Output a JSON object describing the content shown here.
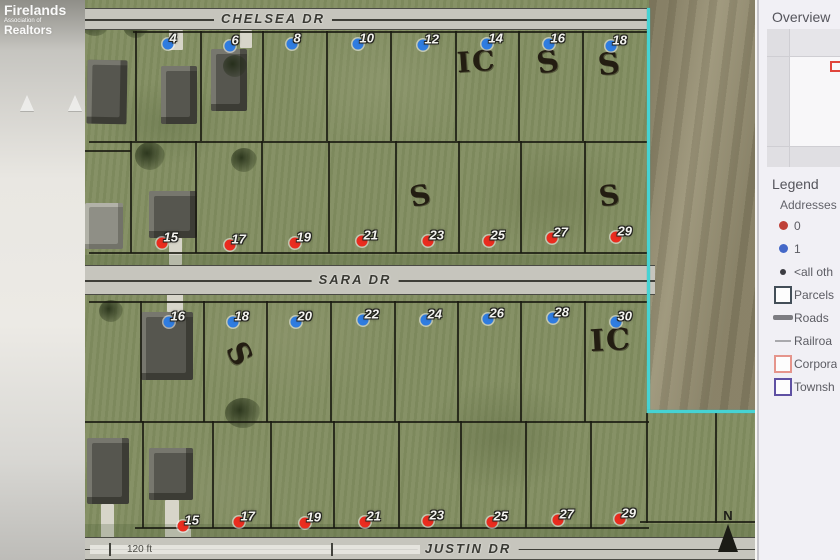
{
  "watermark": {
    "line1": "Firelands",
    "line2": "Association of",
    "line3": "Realtors"
  },
  "map": {
    "streets": {
      "top": "CHELSEA DR",
      "middle": "SARA DR",
      "bottom": "JUSTIN DR"
    },
    "scale_label": "120 ft",
    "north_label": "N",
    "colors": {
      "address0": "#ea2c1f",
      "address1": "#2f7ce0",
      "boundary": "#46d3d3"
    },
    "lots": {
      "chelsea_south": [
        {
          "n": "4",
          "x": 83,
          "y": 44,
          "c": "blue"
        },
        {
          "n": "6",
          "x": 145,
          "y": 46,
          "c": "blue"
        },
        {
          "n": "8",
          "x": 207,
          "y": 44,
          "c": "blue"
        },
        {
          "n": "10",
          "x": 273,
          "y": 44,
          "c": "blue"
        },
        {
          "n": "12",
          "x": 338,
          "y": 45,
          "c": "blue"
        },
        {
          "n": "14",
          "x": 402,
          "y": 44,
          "c": "blue"
        },
        {
          "n": "16",
          "x": 464,
          "y": 44,
          "c": "blue"
        },
        {
          "n": "18",
          "x": 526,
          "y": 46,
          "c": "blue"
        }
      ],
      "sara_north": [
        {
          "n": "15",
          "x": 77,
          "y": 243,
          "c": "red"
        },
        {
          "n": "17",
          "x": 145,
          "y": 245,
          "c": "red"
        },
        {
          "n": "19",
          "x": 210,
          "y": 243,
          "c": "red"
        },
        {
          "n": "21",
          "x": 277,
          "y": 241,
          "c": "red"
        },
        {
          "n": "23",
          "x": 343,
          "y": 241,
          "c": "red"
        },
        {
          "n": "25",
          "x": 404,
          "y": 241,
          "c": "red"
        },
        {
          "n": "27",
          "x": 467,
          "y": 238,
          "c": "red"
        },
        {
          "n": "29",
          "x": 531,
          "y": 237,
          "c": "red"
        }
      ],
      "sara_south": [
        {
          "n": "16",
          "x": 84,
          "y": 322,
          "c": "blue"
        },
        {
          "n": "18",
          "x": 148,
          "y": 322,
          "c": "blue"
        },
        {
          "n": "20",
          "x": 211,
          "y": 322,
          "c": "blue"
        },
        {
          "n": "22",
          "x": 278,
          "y": 320,
          "c": "blue"
        },
        {
          "n": "24",
          "x": 341,
          "y": 320,
          "c": "blue"
        },
        {
          "n": "26",
          "x": 403,
          "y": 319,
          "c": "blue"
        },
        {
          "n": "28",
          "x": 468,
          "y": 318,
          "c": "blue"
        },
        {
          "n": "30",
          "x": 531,
          "y": 322,
          "c": "blue"
        }
      ],
      "justin_north": [
        {
          "n": "15",
          "x": 98,
          "y": 526,
          "c": "red"
        },
        {
          "n": "17",
          "x": 154,
          "y": 522,
          "c": "red"
        },
        {
          "n": "19",
          "x": 220,
          "y": 523,
          "c": "red"
        },
        {
          "n": "21",
          "x": 280,
          "y": 522,
          "c": "red"
        },
        {
          "n": "23",
          "x": 343,
          "y": 521,
          "c": "red"
        },
        {
          "n": "25",
          "x": 407,
          "y": 522,
          "c": "red"
        },
        {
          "n": "27",
          "x": 473,
          "y": 520,
          "c": "red"
        },
        {
          "n": "29",
          "x": 535,
          "y": 519,
          "c": "red"
        }
      ]
    },
    "annotations": [
      {
        "text": "IC",
        "x": 372,
        "y": 48,
        "rot": -4,
        "size": 28
      },
      {
        "text": "S",
        "x": 452,
        "y": 48,
        "rot": -10,
        "size": 30
      },
      {
        "text": "S",
        "x": 513,
        "y": 50,
        "rot": -6,
        "size": 30
      },
      {
        "text": "S",
        "x": 325,
        "y": 182,
        "rot": -12,
        "size": 28
      },
      {
        "text": "S",
        "x": 514,
        "y": 182,
        "rot": -8,
        "size": 28
      },
      {
        "text": "S",
        "x": 142,
        "y": 340,
        "rot": 62,
        "size": 30
      },
      {
        "text": "IC",
        "x": 505,
        "y": 326,
        "rot": -3,
        "size": 30
      }
    ],
    "parcels": {
      "horizontals": [
        {
          "x": 48,
          "y": 31,
          "w": 515,
          "h": 2
        },
        {
          "x": 4,
          "y": 141,
          "w": 560,
          "h": 2
        },
        {
          "x": 4,
          "y": 252,
          "w": 560,
          "h": 2
        },
        {
          "x": 4,
          "y": 301,
          "w": 560,
          "h": 2
        },
        {
          "x": 0,
          "y": 421,
          "w": 564,
          "h": 2
        },
        {
          "x": 50,
          "y": 527,
          "w": 514,
          "h": 2
        },
        {
          "x": 555,
          "y": 521,
          "w": 115,
          "h": 2
        },
        {
          "x": 0,
          "y": 150,
          "w": 46,
          "h": 2
        }
      ],
      "verticals": [
        {
          "x": 50,
          "y": 31,
          "w": 2,
          "h": 110
        },
        {
          "x": 115,
          "y": 31,
          "w": 2,
          "h": 110
        },
        {
          "x": 177,
          "y": 31,
          "w": 2,
          "h": 110
        },
        {
          "x": 241,
          "y": 31,
          "w": 2,
          "h": 110
        },
        {
          "x": 305,
          "y": 31,
          "w": 2,
          "h": 110
        },
        {
          "x": 370,
          "y": 31,
          "w": 2,
          "h": 110
        },
        {
          "x": 433,
          "y": 31,
          "w": 2,
          "h": 110
        },
        {
          "x": 497,
          "y": 31,
          "w": 2,
          "h": 110
        },
        {
          "x": 45,
          "y": 141,
          "w": 2,
          "h": 112
        },
        {
          "x": 110,
          "y": 141,
          "w": 2,
          "h": 112
        },
        {
          "x": 176,
          "y": 141,
          "w": 2,
          "h": 112
        },
        {
          "x": 243,
          "y": 141,
          "w": 2,
          "h": 112
        },
        {
          "x": 310,
          "y": 141,
          "w": 2,
          "h": 112
        },
        {
          "x": 373,
          "y": 141,
          "w": 2,
          "h": 112
        },
        {
          "x": 435,
          "y": 141,
          "w": 2,
          "h": 112
        },
        {
          "x": 499,
          "y": 141,
          "w": 2,
          "h": 112
        },
        {
          "x": 55,
          "y": 301,
          "w": 2,
          "h": 121
        },
        {
          "x": 118,
          "y": 301,
          "w": 2,
          "h": 121
        },
        {
          "x": 181,
          "y": 301,
          "w": 2,
          "h": 121
        },
        {
          "x": 245,
          "y": 301,
          "w": 2,
          "h": 121
        },
        {
          "x": 309,
          "y": 301,
          "w": 2,
          "h": 121
        },
        {
          "x": 372,
          "y": 301,
          "w": 2,
          "h": 121
        },
        {
          "x": 435,
          "y": 301,
          "w": 2,
          "h": 121
        },
        {
          "x": 499,
          "y": 301,
          "w": 2,
          "h": 121
        },
        {
          "x": 57,
          "y": 421,
          "w": 2,
          "h": 107
        },
        {
          "x": 127,
          "y": 421,
          "w": 2,
          "h": 107
        },
        {
          "x": 185,
          "y": 421,
          "w": 2,
          "h": 107
        },
        {
          "x": 248,
          "y": 421,
          "w": 2,
          "h": 107
        },
        {
          "x": 313,
          "y": 421,
          "w": 2,
          "h": 107
        },
        {
          "x": 375,
          "y": 421,
          "w": 2,
          "h": 107
        },
        {
          "x": 440,
          "y": 421,
          "w": 2,
          "h": 107
        },
        {
          "x": 505,
          "y": 421,
          "w": 2,
          "h": 107
        },
        {
          "x": 561,
          "y": 413,
          "w": 2,
          "h": 110
        },
        {
          "x": 630,
          "y": 413,
          "w": 2,
          "h": 110
        }
      ]
    }
  },
  "panel": {
    "overview_title": "Overview",
    "legend_title": "Legend",
    "addresses_label": "Addresses",
    "legend_items": [
      {
        "label": "0",
        "swatch": "dot-red"
      },
      {
        "label": "1",
        "swatch": "dot-blue"
      },
      {
        "label": "<all oth",
        "swatch": "dot-small"
      },
      {
        "label": "Parcels",
        "swatch": "sq-gray"
      },
      {
        "label": "Roads",
        "swatch": "line-thick"
      },
      {
        "label": "Railroa",
        "swatch": "line-thin"
      },
      {
        "label": "Corpora",
        "swatch": "sq-red"
      },
      {
        "label": "Townsh",
        "swatch": "sq-purple"
      }
    ]
  }
}
